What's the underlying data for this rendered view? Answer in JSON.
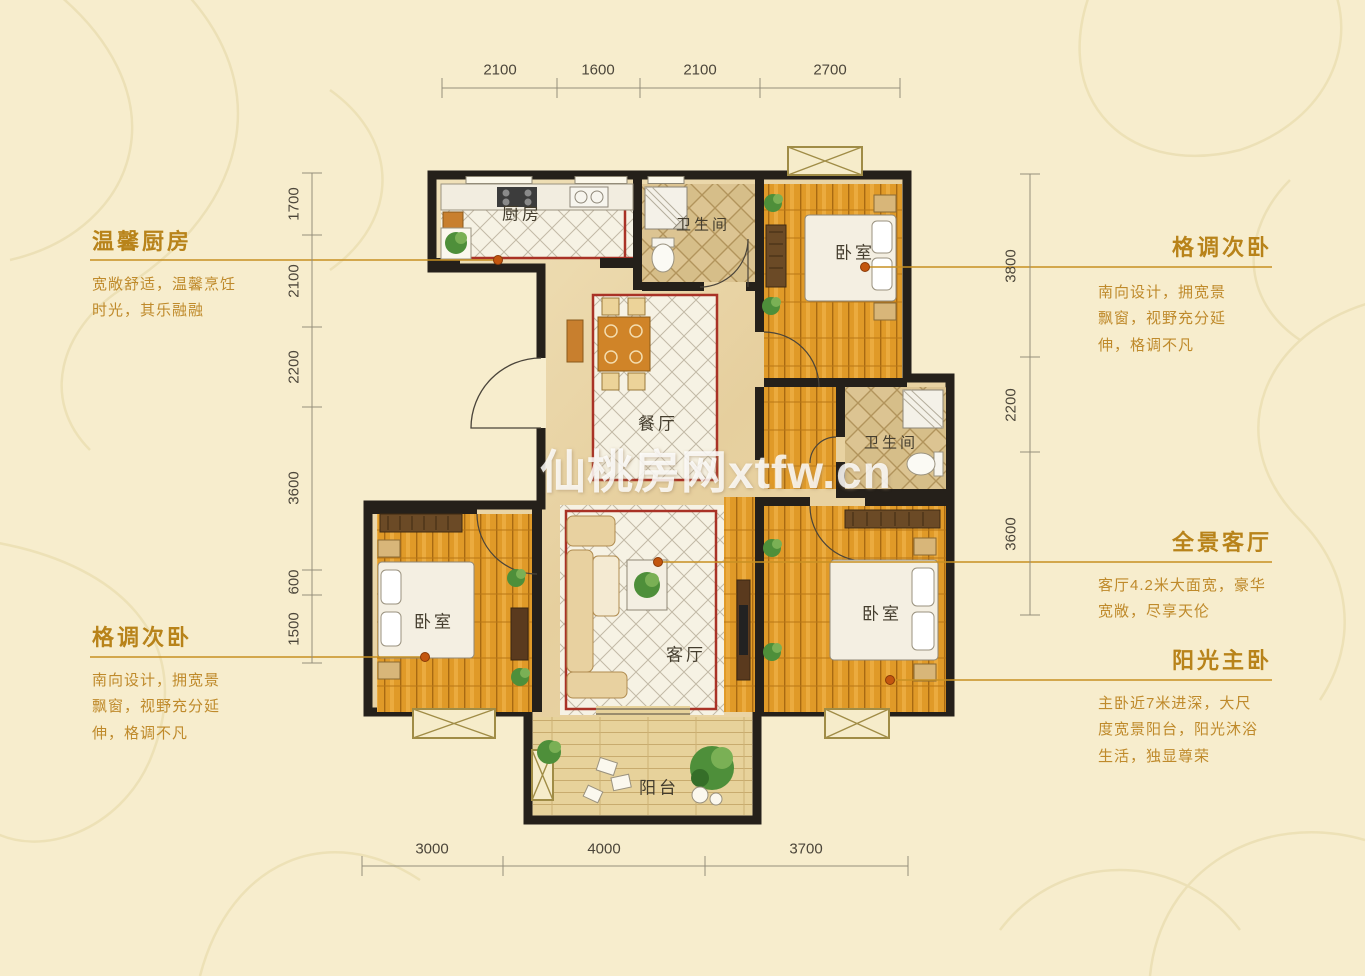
{
  "page": {
    "watermark": "仙桃房网xtfw.cn"
  },
  "rooms": {
    "kitchen": "厨房",
    "bathroom_top": "卫生间",
    "bedroom_northeast": "卧室",
    "dining": "餐厅",
    "bathroom_middle": "卫生间",
    "bedroom_west": "卧室",
    "living": "客厅",
    "bedroom_southeast": "卧室",
    "balcony": "阳台"
  },
  "callouts": {
    "kitchen": {
      "title": "温馨厨房",
      "description": "宽敞舒适，温馨烹饪时光，其乐融融"
    },
    "bedroom_northeast": {
      "title": "格调次卧",
      "description": "南向设计，拥宽景飘窗，视野充分延伸，格调不凡"
    },
    "bedroom_west": {
      "title": "格调次卧",
      "description": "南向设计，拥宽景飘窗，视野充分延伸，格调不凡"
    },
    "living": {
      "title": "全景客厅",
      "description": "客厅4.2米大面宽，豪华宽敞，尽享天伦"
    },
    "master": {
      "title": "阳光主卧",
      "description": "主卧近7米进深，大尺度宽景阳台，阳光沐浴生活，独显尊荣"
    }
  },
  "dimensions": {
    "top": [
      "2100",
      "1600",
      "2100",
      "2700"
    ],
    "bottom": [
      "3000",
      "4000",
      "3700"
    ],
    "left": [
      "1700",
      "2100",
      "2200",
      "3600",
      "600",
      "1500"
    ],
    "right": [
      "3800",
      "2200",
      "3600"
    ]
  },
  "colors": {
    "background": "#f7edcd",
    "accent_gold": "#b8831a",
    "wall": "#25201a",
    "red_outline": "#a93226",
    "wood": "#e09a28",
    "leader_line": "#c79022",
    "leader_dot": "#c3560f"
  }
}
